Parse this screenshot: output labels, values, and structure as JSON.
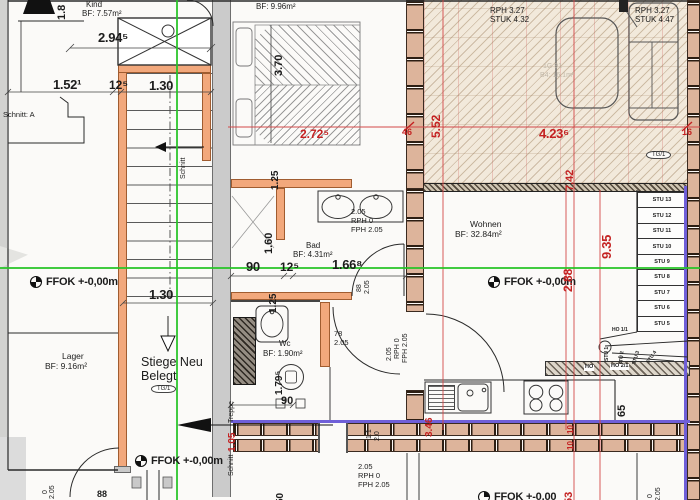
{
  "drawing": {
    "rooms": {
      "kind": {
        "name": "Kind",
        "area": "BF: 7.57m²"
      },
      "schlafen": {
        "area": "BF: 9.96m²"
      },
      "bad": {
        "name": "Bad",
        "area": "BF: 4.31m²"
      },
      "wc": {
        "name": "Wc",
        "area": "BF: 1.90m²"
      },
      "wohnen": {
        "name": "Wohnen",
        "area": "BF: 32.84m²"
      },
      "lager": {
        "name": "Lager",
        "area": "BF: 9.16m²"
      },
      "stiege": {
        "line1": "Stiege Neu",
        "line2": "Belegt",
        "tag": "TG/1"
      }
    },
    "terrace": {
      "zone_left": {
        "rph": "RPH 3.27",
        "stuk": "STUK 4.32"
      },
      "zone_right": {
        "rph": "RPH 3.27",
        "stuk": "STUK 4.47"
      },
      "faint1": "1G 91",
      "faint2": "B4: 16.1m²",
      "tag": "TG/1"
    },
    "levels": {
      "ffok": "FFOK +-0,00m",
      "ffok_cut": "FFOK +-0,00"
    },
    "section": {
      "schnitt_a": "Schnitt: A",
      "schnitt": "Schnitt",
      "treppe": "Treppe"
    },
    "dims": {
      "d294": "2.94⁵",
      "d18": "1.8",
      "d152": "1.52¹",
      "d125a": "12⁵",
      "d130a": "1.30",
      "d370": "3.70",
      "d130b": "1.30",
      "d125wall_a": "1.25",
      "d160": "1.60",
      "d125wall_b": "1.25",
      "d90bad": "90",
      "d125b": "12⁵",
      "d166": "1.66⁸",
      "d179": "1.79⁵",
      "d90wc": "90",
      "d65": "65",
      "d88door": "88",
      "d50": "50"
    },
    "red_dims": {
      "d272": "2.72⁵",
      "d46": "46",
      "d552": "5.52",
      "d423": "4.23⁶",
      "d16": "16",
      "d742": "7.42",
      "d935": "9.35",
      "d288": "2.88",
      "d346": "3.46",
      "d105": "1.05",
      "d10a": "10",
      "d10b": "10",
      "d53": "53"
    },
    "door_specs": {
      "bad_sink": [
        "2.05",
        "RPH 0",
        "FPH 2.05"
      ],
      "wc_door": [
        "78",
        "2.05"
      ],
      "bad_door": [
        "88",
        "2.05"
      ],
      "hall_door": [
        "2.05",
        "RPH 0",
        "FPH 2.05"
      ],
      "bottom_door": [
        "2.05",
        "RPH 0",
        "FPH 2.05"
      ],
      "bottom_left": [
        "2.05",
        "0"
      ],
      "bottom_right": [
        "2.05",
        "0"
      ],
      "mid_door": [
        "1.1",
        "2.0"
      ]
    },
    "stairs": {
      "straight": [
        "STU 13",
        "STU 12",
        "STU 11",
        "STU 10",
        "STU 9",
        "STU 8",
        "STU 7",
        "STU 6",
        "STU 5"
      ],
      "winders": [
        "STU 4",
        "STU 3",
        "STU 2",
        "STU 1"
      ],
      "ho": "HO",
      "ho11": "HO 1/1",
      "ho21": "HO 2/1"
    },
    "colors": {
      "wall_orange": "#f2a87c",
      "brick": "#ddb49b",
      "grid_green": "#27c427",
      "dim_red": "#c42222",
      "insulation_blue": "#6f5fd8",
      "terrace_beige": "#f2e9db"
    }
  }
}
